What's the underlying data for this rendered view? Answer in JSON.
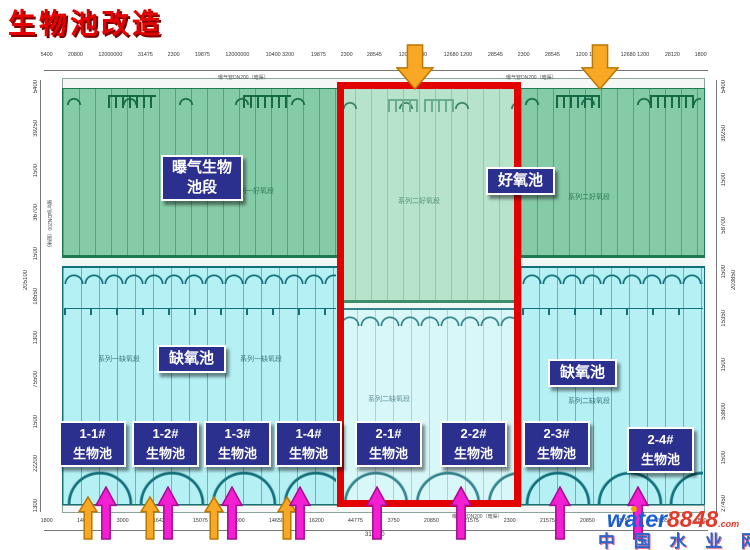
{
  "title": "生物池改造",
  "labels": {
    "aeration_line1": "曝气生物",
    "aeration_line2": "池段",
    "aerobic": "好氧池",
    "anoxic_left": "缺氧池",
    "anoxic_right": "缺氧池",
    "pool_suffix": "生物池",
    "pools": [
      {
        "id": "1-1#"
      },
      {
        "id": "1-2#"
      },
      {
        "id": "1-3#"
      },
      {
        "id": "1-4#"
      },
      {
        "id": "2-1#"
      },
      {
        "id": "2-2#"
      },
      {
        "id": "2-3#"
      },
      {
        "id": "2-4#"
      }
    ]
  },
  "faint_labels": {
    "s1_aerobic": "系列一好氧段",
    "s2_aerobic_mid": "系列二好氧段",
    "s2_aerobic_right": "系列二好氧段",
    "s1_anoxic_a": "系列一缺氧段",
    "s1_anoxic_b": "系列一缺氧段",
    "s2_anoxic_mid": "系列二缺氧段",
    "s2_anoxic_right": "系列二缺氧段",
    "pipe_note": "曝气管DN200（暗渠）"
  },
  "dimensions": {
    "top": [
      "5400",
      "20800",
      "12000000",
      "31475",
      "2300",
      "19875",
      "12000000",
      "10400 3200",
      "19875",
      "2300",
      "28545",
      "1200 12680",
      "12680 1200",
      "28545",
      "2300",
      "28545",
      "1200 12680",
      "12680 1200",
      "28120",
      "1800"
    ],
    "bottom": [
      "1800",
      "14650",
      "3000",
      "16425",
      "15075",
      "3000",
      "14650",
      "16200",
      "44775",
      "3750",
      "20850",
      "21575",
      "2300",
      "21575",
      "20850",
      "3750",
      "20850",
      "1800"
    ],
    "bottom_total": "311950",
    "left": [
      "5400",
      "39250",
      "1500",
      "36700",
      "1500",
      "18550",
      "1300",
      "75500",
      "1500",
      "22200",
      "1300"
    ],
    "left_total": "205100",
    "right": [
      "5400",
      "39250",
      "1500",
      "58700",
      "1500",
      "15350",
      "1500",
      "53800",
      "1500",
      "27450"
    ],
    "right_total": "203850"
  },
  "arrows": {
    "top_inlets": [
      {
        "x": 415
      },
      {
        "x": 600
      }
    ],
    "bottom_orange": [
      {
        "x": 88
      },
      {
        "x": 150
      },
      {
        "x": 214
      },
      {
        "x": 287
      }
    ],
    "bottom_magenta": [
      {
        "x": 106
      },
      {
        "x": 168
      },
      {
        "x": 232
      },
      {
        "x": 300
      },
      {
        "x": 377
      },
      {
        "x": 461
      },
      {
        "x": 560
      },
      {
        "x": 638
      }
    ]
  },
  "watermark": {
    "brand": "water",
    "number": "8848",
    "domain": ".com",
    "site": "中 国 水 业 网"
  },
  "colors": {
    "title_red": "#e60000",
    "highlight_red": "#e20000",
    "label_navy": "#2b2f8e",
    "pool_green": "#86cba7",
    "pool_green_faded": "#abdec2",
    "pool_cyan": "#b5f1f4",
    "pool_cyan_faded": "#d2f6f8",
    "arrow_orange": "#f9a825",
    "arrow_orange_stroke": "#b97700",
    "arrow_magenta": "#f21fd3",
    "arrow_magenta_stroke": "#a50c90",
    "watermark_blue": "#1b5fd0",
    "watermark_red": "#e23a2a"
  }
}
